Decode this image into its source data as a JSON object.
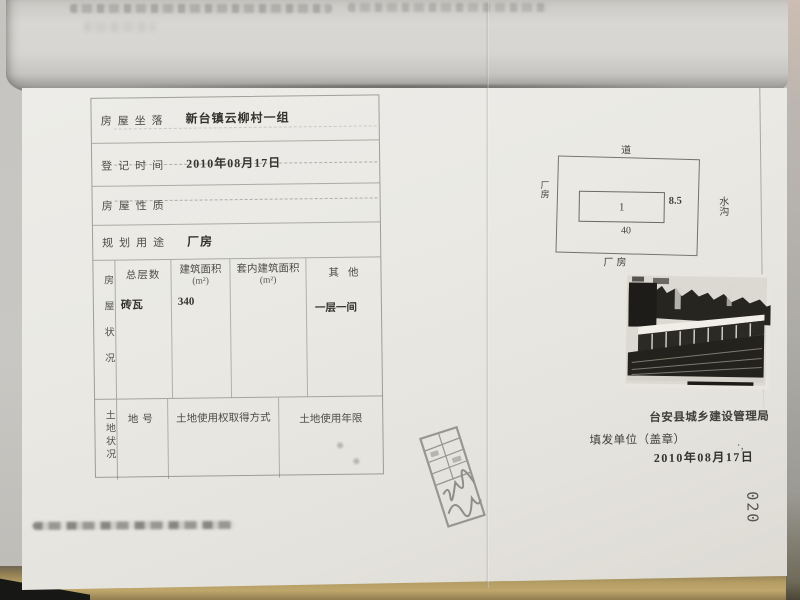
{
  "document": {
    "type_hint": "房屋登记表（扫描件）",
    "page_number": "020"
  },
  "form": {
    "rows": [
      {
        "label": "房屋坐落",
        "value": "新台镇云柳村一组"
      },
      {
        "label": "登记时间",
        "value": "2010年08月17日"
      },
      {
        "label": "房屋性质",
        "value": ""
      },
      {
        "label": "规划用途",
        "value": "厂房"
      }
    ],
    "building_section": {
      "side_label": "房屋状况",
      "headers": [
        "总层数",
        "建筑面积",
        "套内建筑面积",
        "其他"
      ],
      "units": [
        "",
        "(m²)",
        "(m²)",
        ""
      ],
      "row": [
        "砖瓦",
        "340",
        "",
        "一层一间"
      ]
    },
    "land_section": {
      "side_label": "土地状况",
      "headers": [
        "地号",
        "土地使用权取得方式",
        "土地使用年限"
      ]
    }
  },
  "site_plan": {
    "road_label": "道",
    "left_label": "厂房",
    "right_label": "水沟",
    "bottom_label": "厂房",
    "building_mark": "1",
    "width_value": "8.5",
    "length_value": "40"
  },
  "footer": {
    "agency": "台安县城乡建设管理局",
    "issuer_label": "填发单位（盖章）",
    "date": "2010年08月17日"
  },
  "colors": {
    "paper": "#e9e7e2",
    "ink": "#3c3b35",
    "desk_wood": "#b3995f"
  }
}
